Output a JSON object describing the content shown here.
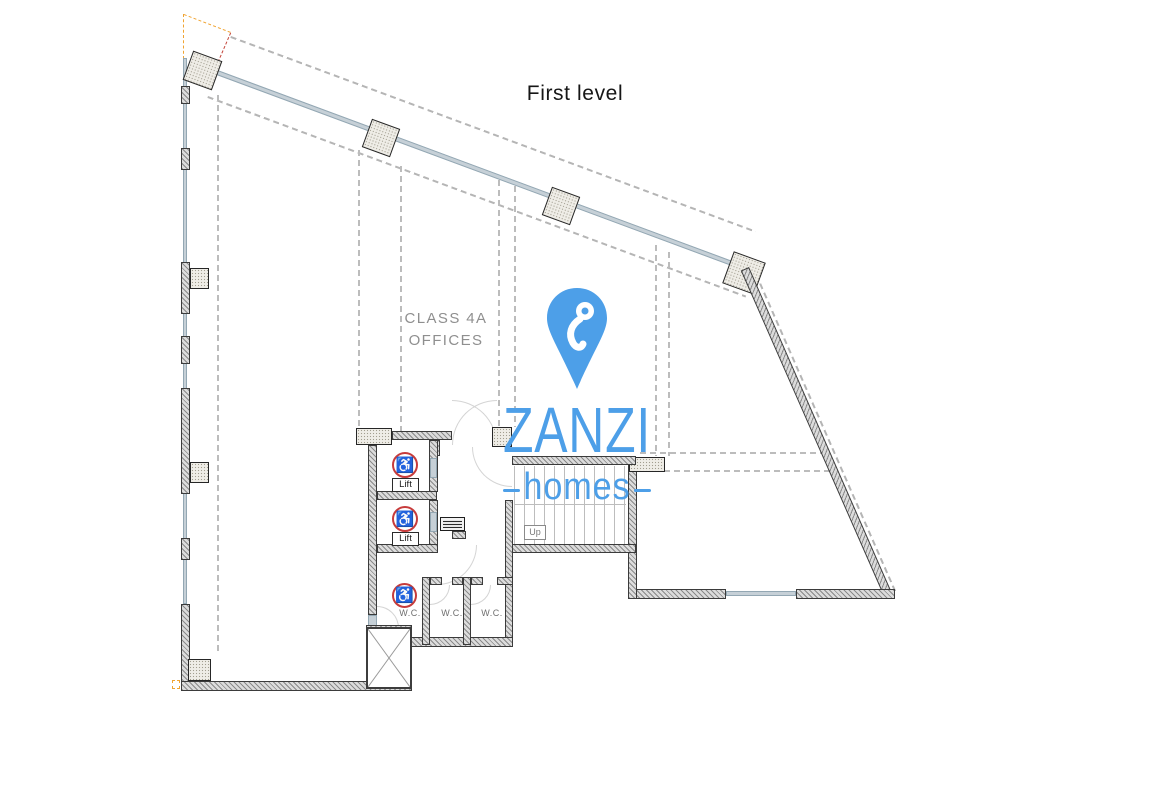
{
  "title": "First level",
  "plan": {
    "zone_label": {
      "line1": "CLASS 4A",
      "line2": "OFFICES"
    },
    "lift_labels": [
      "Lift",
      "Lift"
    ],
    "wc_labels": [
      "W.C.",
      "W.C.",
      "W.C."
    ],
    "stair_up_label": "Up",
    "wheelchair_symbol": "♿"
  },
  "logo": {
    "brand": "ZANZI",
    "tagline": "homes",
    "pin_color": "#4d9fe8",
    "text_color": "#4d9fe8"
  },
  "colors": {
    "wall_dark": "#3b3b3b",
    "glazing_blue_gray": "#c6d0d7",
    "accessible_ring_red": "#c73b3b",
    "guide_orange": "#f0a432",
    "guide_red": "#c4453a",
    "dashed_guide_gray": "#bcbcbc"
  }
}
